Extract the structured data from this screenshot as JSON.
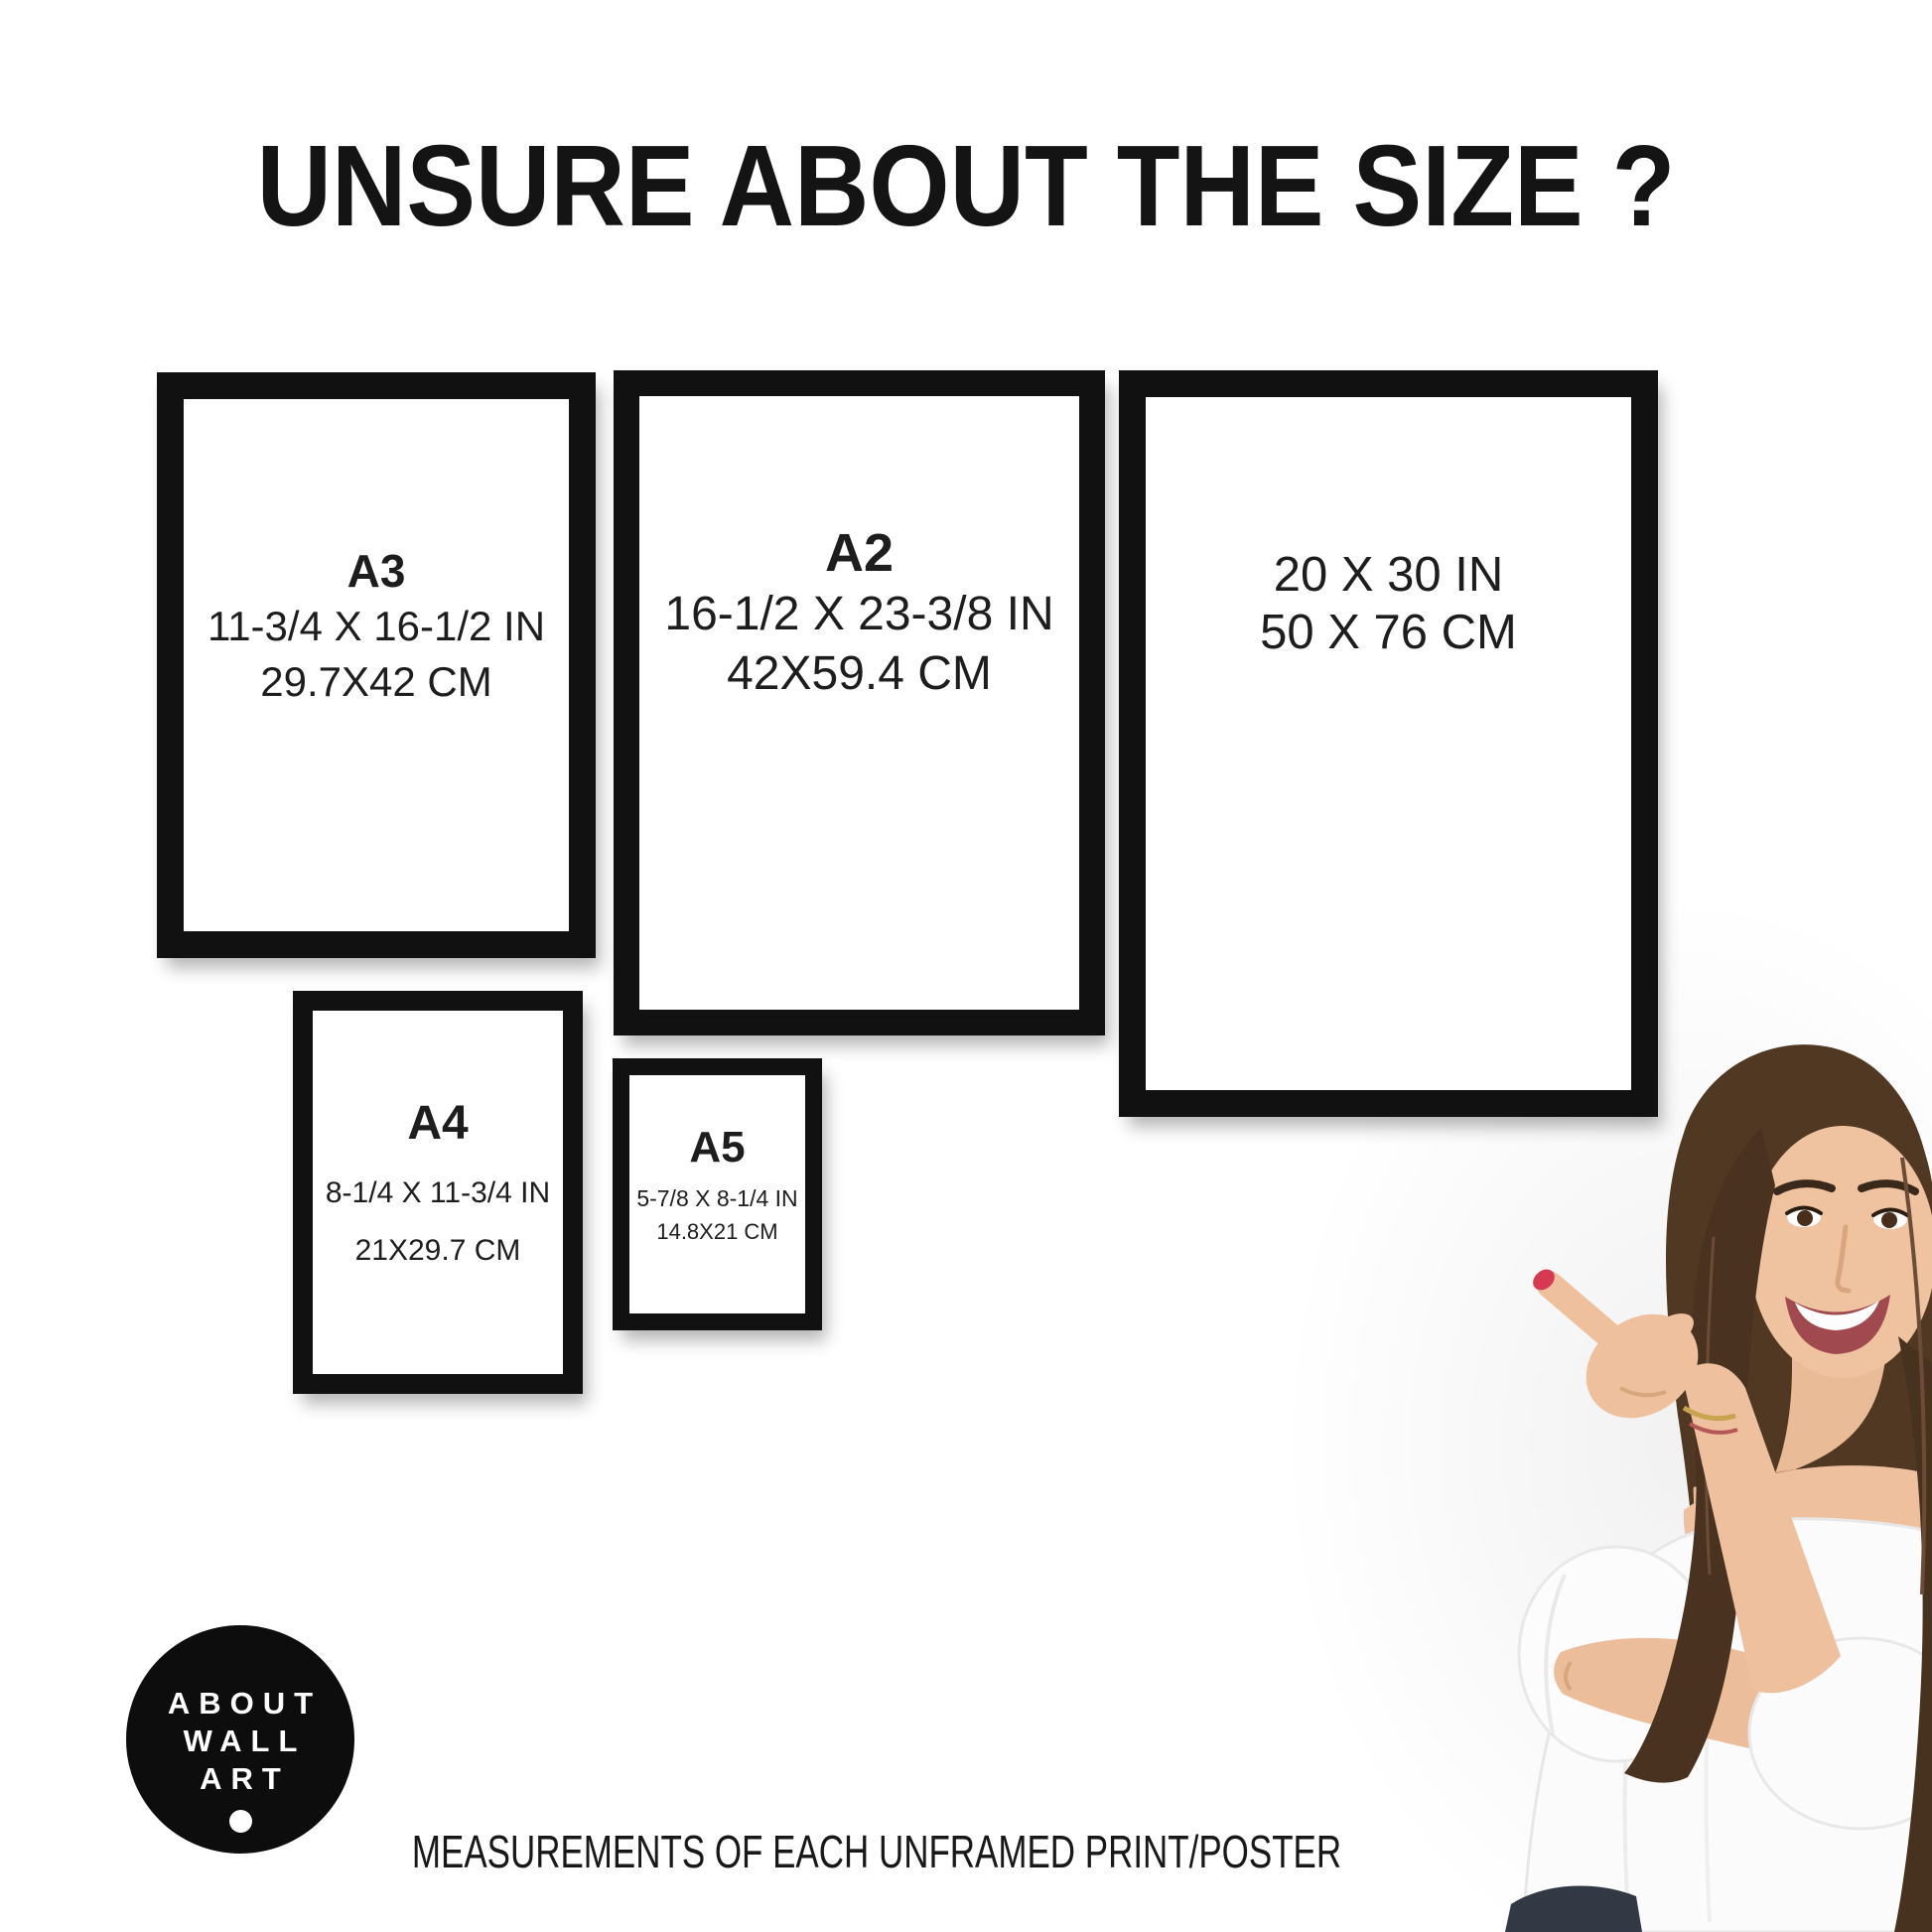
{
  "title": "UNSURE ABOUT THE SIZE ?",
  "frames": [
    {
      "name": "A3",
      "label": "A3",
      "inches": "11-3/4 X 16-1/2 IN",
      "cm": "29.7X42 CM"
    },
    {
      "name": "A2",
      "label": "A2",
      "inches": "16-1/2 X 23-3/8 IN",
      "cm": "42X59.4 CM"
    },
    {
      "name": "20x30",
      "label": "",
      "inches": "20 X 30 IN",
      "cm": "50 X 76 CM"
    },
    {
      "name": "A4",
      "label": "A4",
      "inches": "8-1/4 X 11-3/4 IN",
      "cm": "21X29.7 CM"
    },
    {
      "name": "A5",
      "label": "A5",
      "inches": "5-7/8 X 8-1/4 IN",
      "cm": "14.8X21 CM"
    }
  ],
  "logo": {
    "lines": [
      "ABOUT",
      "WALL",
      "ART"
    ]
  },
  "footer": "MEASUREMENTS OF EACH UNFRAMED PRINT/POSTER",
  "photo_alt": "Smiling young woman with long brown hair in a white off-shoulder top pointing at the frames",
  "colors": {
    "background": "#ffffff",
    "frame": "#111111",
    "text": "#1d1d1d",
    "logo_bg": "#0d0d0d",
    "logo_text": "#ffffff",
    "nail": "#d63a52",
    "hair": "#503823",
    "skin": "#eec09e",
    "jeans": "#333845"
  }
}
